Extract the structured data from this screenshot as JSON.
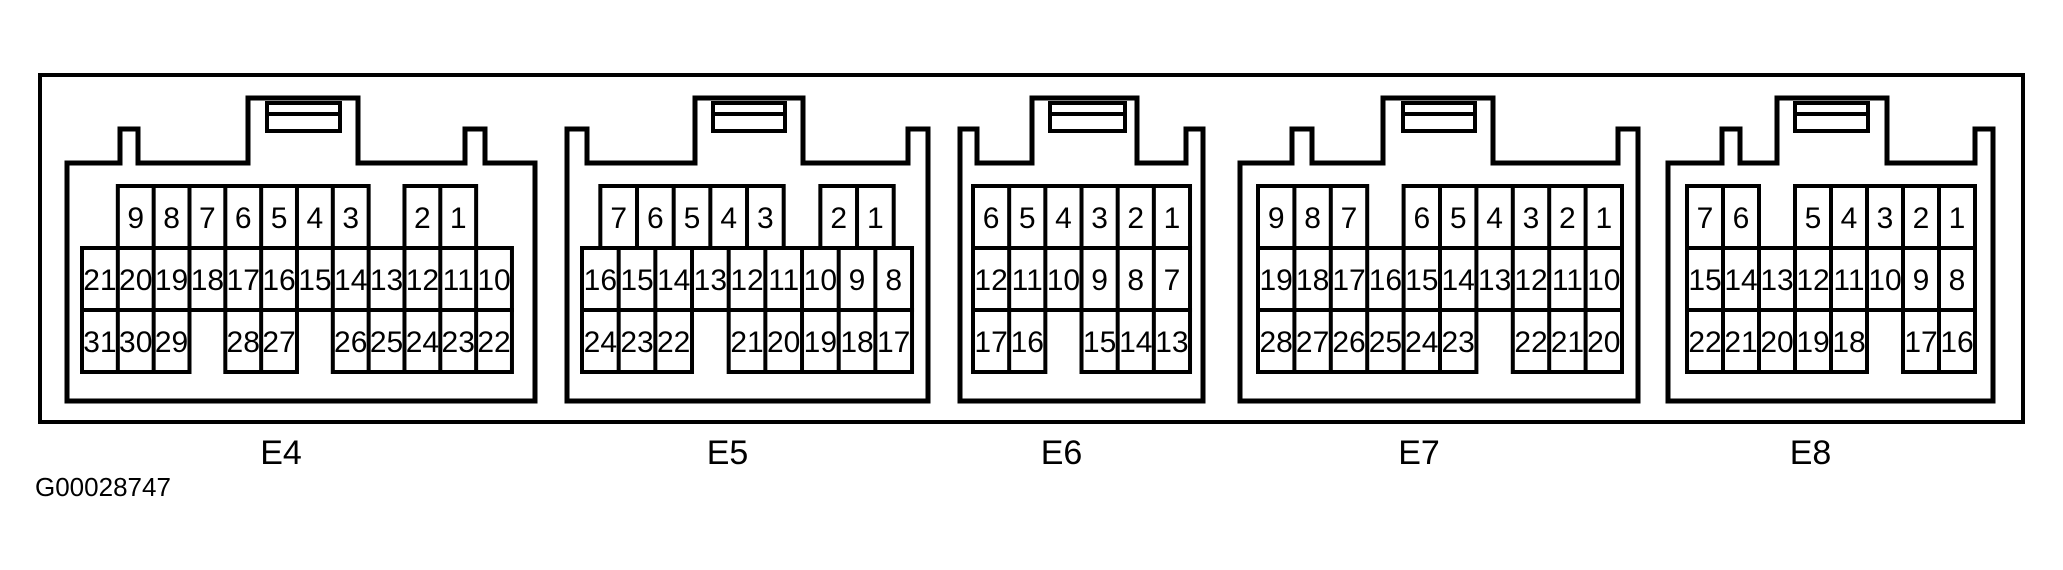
{
  "figure_code": "G00028747",
  "colors": {
    "line": "#000000",
    "background": "#ffffff"
  },
  "connectors": [
    {
      "id": "E4",
      "label": "E4",
      "top_staggered": false,
      "rows": {
        "top": [
          null,
          "9",
          "8",
          "7",
          "6",
          "5",
          "4",
          "3",
          null,
          "2",
          "1",
          null
        ],
        "middle": [
          "21",
          "20",
          "19",
          "18",
          "17",
          "16",
          "15",
          "14",
          "13",
          "12",
          "11",
          "10"
        ],
        "bottom": [
          "31",
          "30",
          "29",
          null,
          "28",
          "27",
          null,
          "26",
          "25",
          "24",
          "23",
          "22"
        ]
      }
    },
    {
      "id": "E5",
      "label": "E5",
      "top_staggered": true,
      "rows": {
        "top": [
          "7",
          "6",
          "5",
          "4",
          "3",
          null,
          "2",
          "1"
        ],
        "middle": [
          "16",
          "15",
          "14",
          "13",
          "12",
          "11",
          "10",
          "9",
          "8"
        ],
        "bottom": [
          "24",
          "23",
          "22",
          null,
          "21",
          "20",
          "19",
          "18",
          "17"
        ]
      }
    },
    {
      "id": "E6",
      "label": "E6",
      "top_staggered": false,
      "rows": {
        "top": [
          "6",
          "5",
          "4",
          "3",
          "2",
          "1"
        ],
        "middle": [
          "12",
          "11",
          "10",
          "9",
          "8",
          "7"
        ],
        "bottom": [
          "17",
          "16",
          null,
          "15",
          "14",
          "13"
        ]
      }
    },
    {
      "id": "E7",
      "label": "E7",
      "top_staggered": false,
      "rows": {
        "top": [
          "9",
          "8",
          "7",
          null,
          "6",
          "5",
          "4",
          "3",
          "2",
          "1"
        ],
        "middle": [
          "19",
          "18",
          "17",
          "16",
          "15",
          "14",
          "13",
          "12",
          "11",
          "10"
        ],
        "bottom": [
          "28",
          "27",
          "26",
          "25",
          "24",
          "23",
          null,
          "22",
          "21",
          "20"
        ]
      }
    },
    {
      "id": "E8",
      "label": "E8",
      "top_staggered": false,
      "rows": {
        "top": [
          "7",
          "6",
          null,
          "5",
          "4",
          "3",
          "2",
          "1"
        ],
        "middle": [
          "15",
          "14",
          "13",
          "12",
          "11",
          "10",
          "9",
          "8"
        ],
        "bottom": [
          "22",
          "21",
          "20",
          "19",
          "18",
          null,
          "17",
          "16"
        ]
      }
    }
  ]
}
